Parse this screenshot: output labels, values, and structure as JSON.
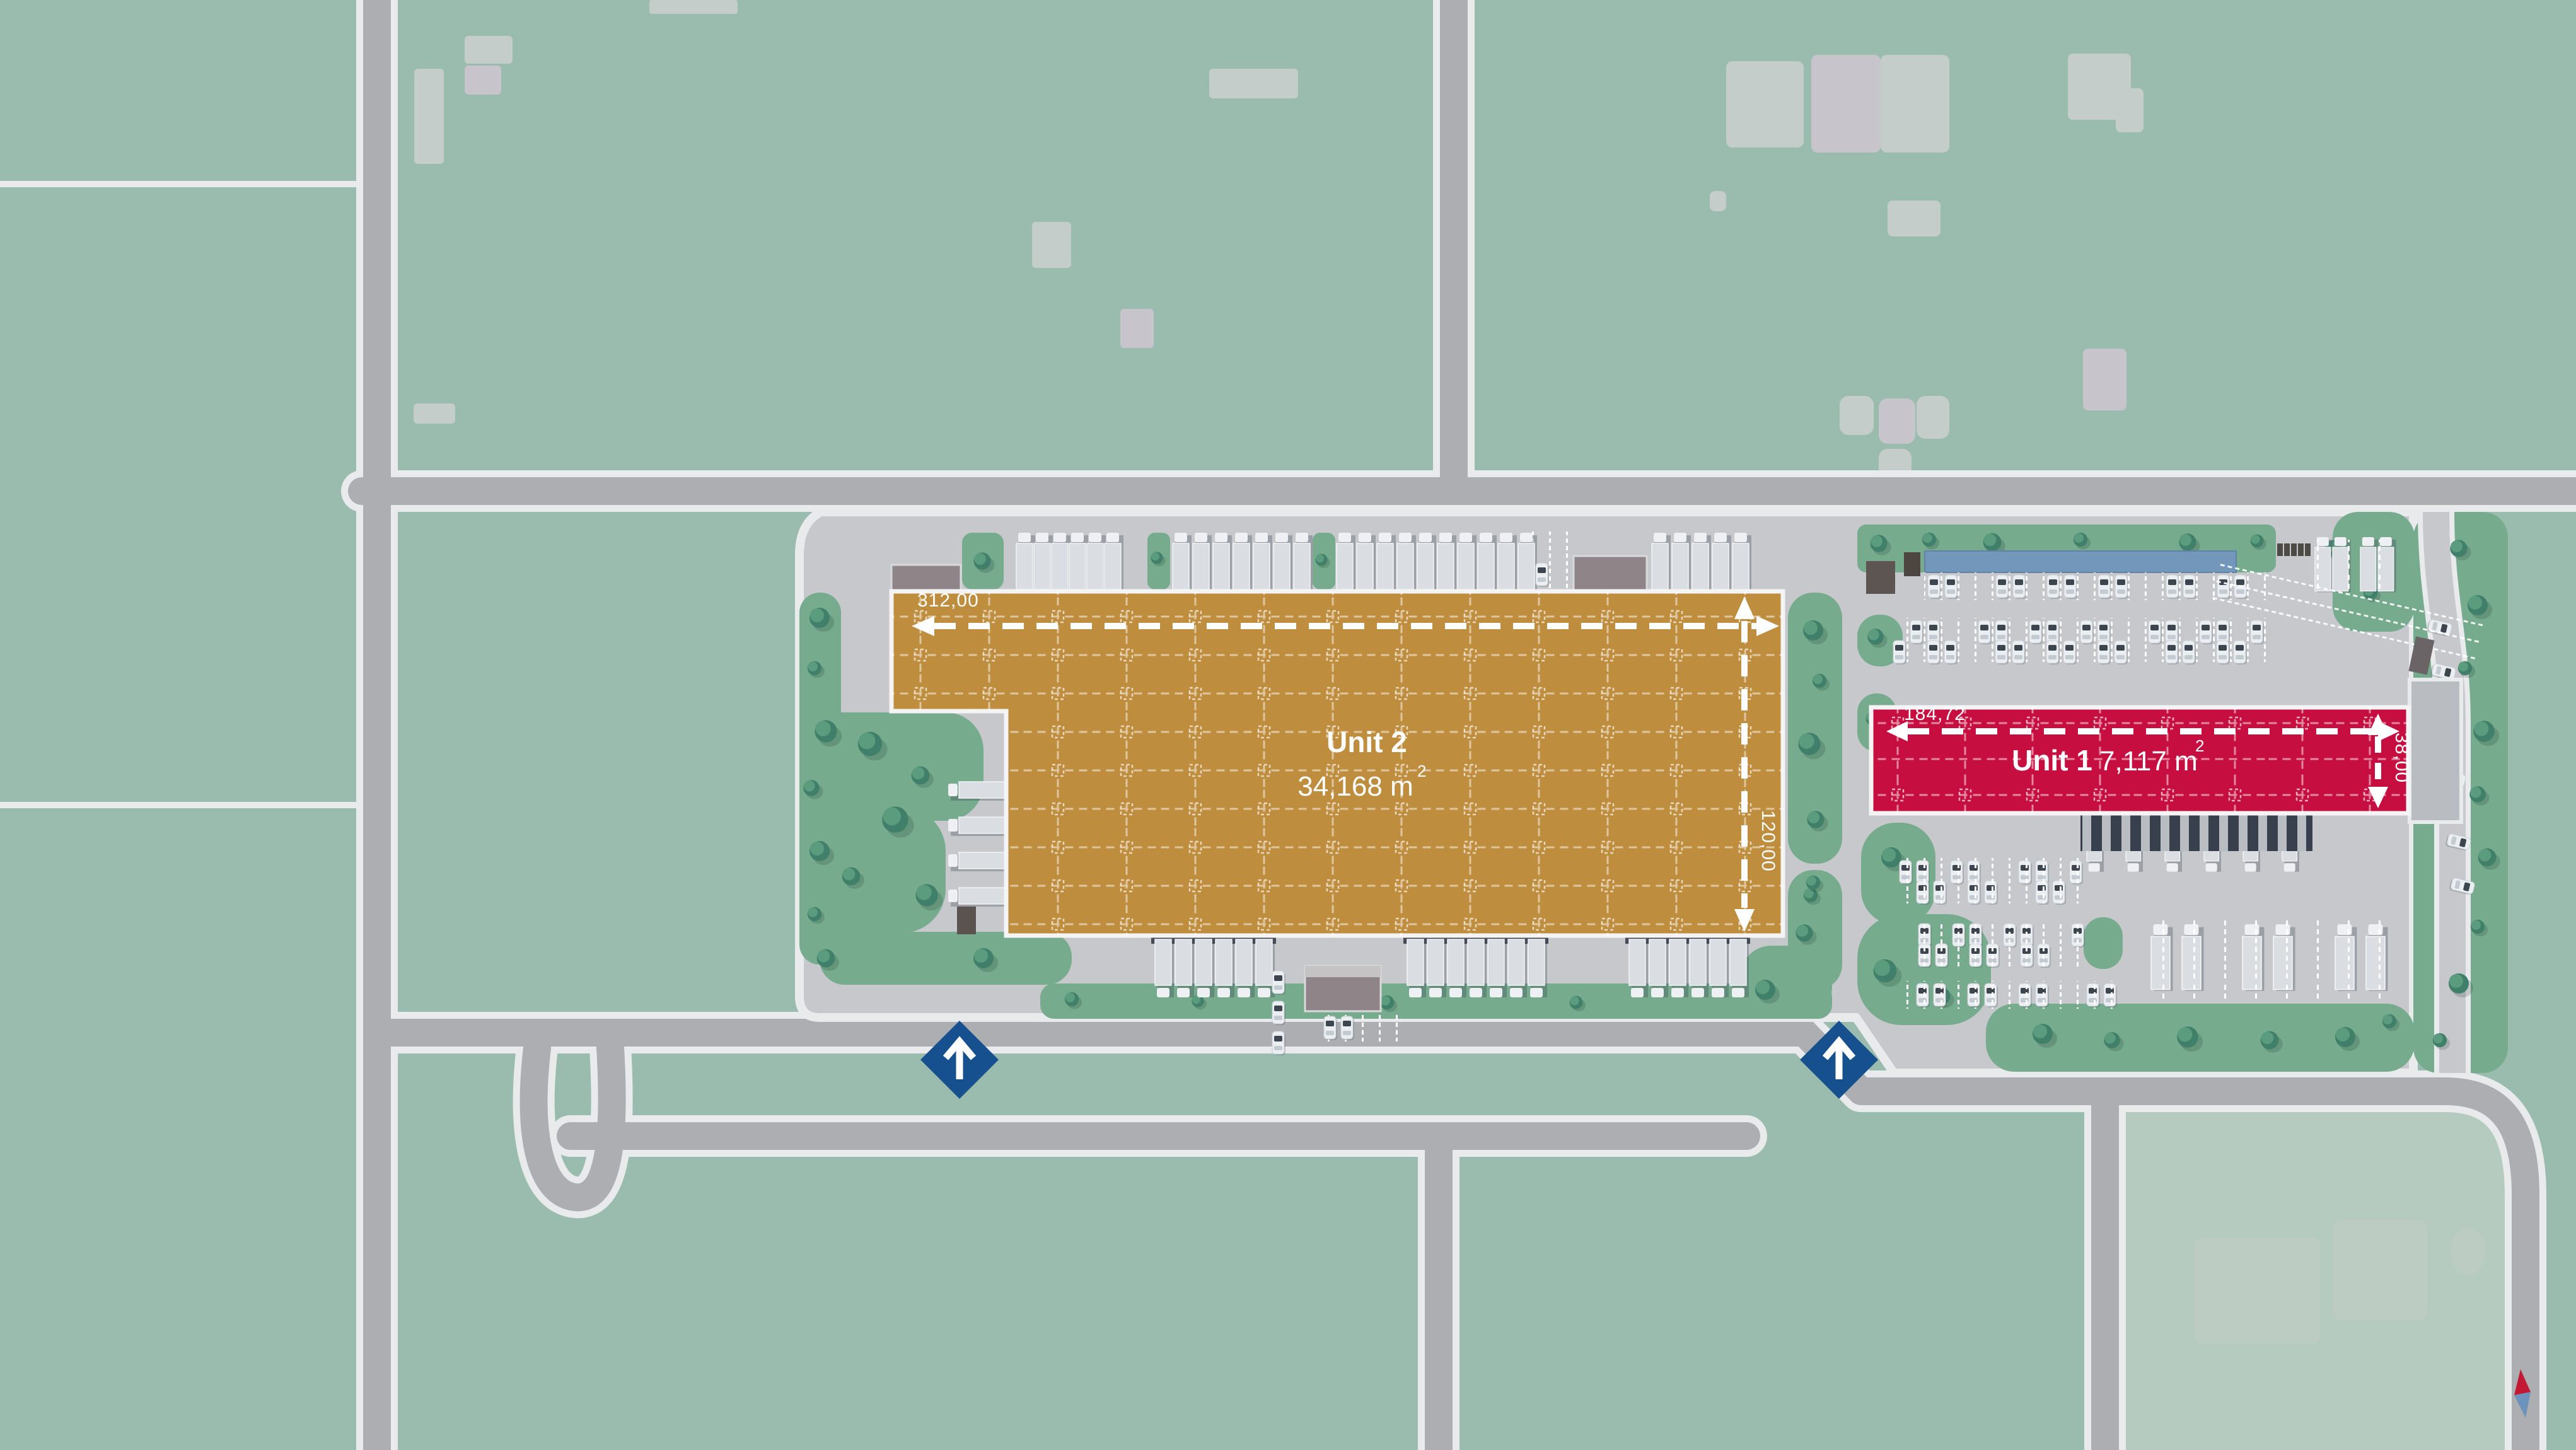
{
  "units": [
    {
      "name": "Unit 2",
      "area_label": "34,168 m",
      "area_sup": "2",
      "dim_width": "312,00",
      "dim_height": "120,00",
      "color": "#bf8d3e"
    },
    {
      "name": "Unit 1",
      "area_label": "7,117 m",
      "area_sup": "2",
      "dim_width": "184,72",
      "dim_height": "38,00",
      "color": "#c60f40"
    }
  ],
  "entrances": [
    {
      "id": "entrance-west"
    },
    {
      "id": "entrance-east"
    }
  ],
  "entrance_color": "#17508f",
  "compass": {
    "north": "#c31934",
    "south": "#6b93bd"
  },
  "palette": {
    "field": "#9abcae",
    "field_light": "#b6cbc0",
    "road": "#adaeb2",
    "road_edge": "#e9eaec",
    "pavement": "#c6c8cb",
    "landscape": "#76ab8e"
  }
}
